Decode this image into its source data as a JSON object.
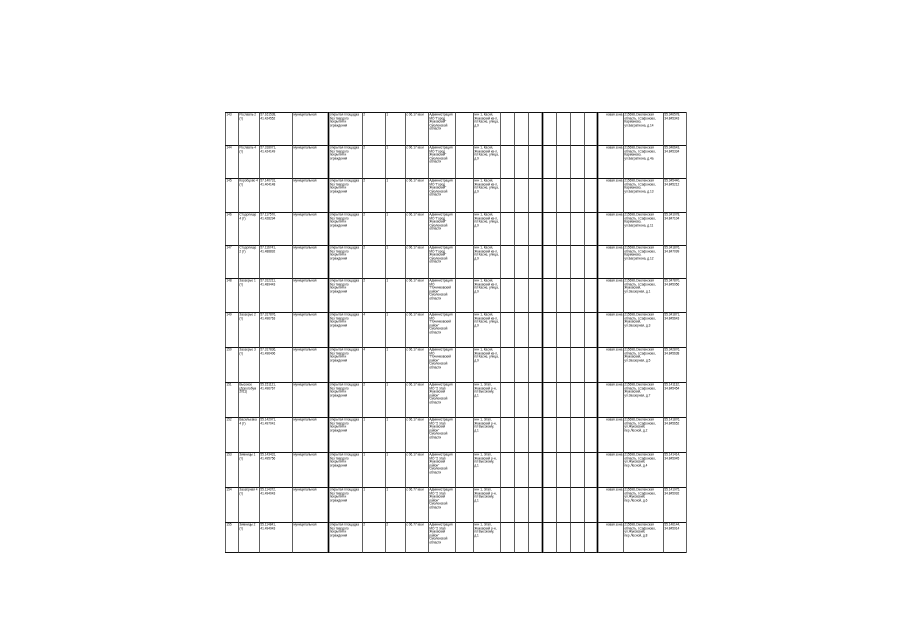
{
  "page": {
    "background_color": "#ffffff",
    "grid_color": "#111111",
    "text_color": "#000000"
  },
  "table": {
    "position": {
      "left": 225,
      "top": 112,
      "width": 461,
      "height": 440
    },
    "columns": [
      {
        "key": "num",
        "width": 13
      },
      {
        "key": "name",
        "width": 21
      },
      {
        "key": "coordinates",
        "width": 33
      },
      {
        "key": "ownership",
        "width": 36
      },
      {
        "key": "description",
        "width": 34
      },
      {
        "key": "count-a",
        "width": 23
      },
      {
        "key": "count-b",
        "width": 20
      },
      {
        "key": "area",
        "width": 23
      },
      {
        "key": "owner",
        "width": 27
      },
      {
        "key": "spacer-1",
        "width": 18
      },
      {
        "key": "location",
        "width": 27
      },
      {
        "key": "spacer-2",
        "width": 14
      },
      {
        "key": "spacer-3",
        "width": 14
      },
      {
        "key": "spacer-4",
        "width": 14
      },
      {
        "key": "spacer-5",
        "width": 14
      },
      {
        "key": "spacer-6",
        "width": 14
      },
      {
        "key": "spacer-7",
        "width": 14
      },
      {
        "key": "spacer-8",
        "width": 13
      },
      {
        "key": "zone-status",
        "width": 26
      },
      {
        "key": "address",
        "width": 40
      },
      {
        "key": "coordinates-2",
        "width": 23
      }
    ],
    "row_heights": [
      33,
      33,
      34,
      33,
      33,
      34,
      35,
      35,
      35,
      35,
      35,
      35,
      30
    ],
    "rows": [
      [
        "143",
        "Рославль 2 (т)",
        "57.161538, 41.424552",
        "муниципальная",
        "открытая площадка без твердого покрытия и ограждения",
        "2",
        "1",
        "с 06.17 кв.м",
        "Администрация МО \"Город Жуковский\" Смоленской области",
        "",
        "м-н 1, Касня, Жуковский кв-л, по Касне, улица, д.9",
        "",
        "",
        "",
        "",
        "",
        "",
        "",
        "новая зона",
        "215698,Смоленская область, г.Сафоново, Карманово, ул.Багратиона, д.14",
        "55.346578, 34.845343"
      ],
      [
        "144",
        "Рославль 4 (т)",
        "57.318071, 41.424149",
        "муниципальная",
        "открытая площадка без твердого покрытия и ограждения",
        "2",
        "1",
        "с 06.17 кв.м",
        "Администрация МО \"Город Жуковский\" Смоленской области",
        "",
        "м-н 1, Касня, Жуковский кв-л, по Касне, улица, д.9",
        "",
        "",
        "",
        "",
        "",
        "",
        "",
        "новая зона",
        "215698,Смоленская область, г.Сафоново, Карманово, ул.Багратиона, д.4а",
        "55.346643, 34.845334"
      ],
      [
        "145",
        "Коробцово 4 (т)",
        "57.140731, 41.404148",
        "муниципальная",
        "открытая площадка без твердого покрытия и ограждения",
        "2",
        "1",
        "с 06.17 кв.м",
        "Администрация МО \"Город Жуковский\" Смоленской области",
        "",
        "м-н 1, Касня, Жуковский кв-л, по Касне, улица, д.9",
        "",
        "",
        "",
        "",
        "",
        "",
        "",
        "новая зона",
        "215698,Смоленская область, г.Сафоново, Карманово, ул.Багратиона, д.13",
        "55.345440, 34.845212"
      ],
      [
        "146",
        "Стодолище 4 (т)",
        "57.117570, 41.428294",
        "муниципальная",
        "открытая площадка без твердого покрытия и ограждения",
        "2",
        "1",
        "с 06.17 кв.м",
        "Администрация МО \"Город Жуковский\" Смоленской области",
        "",
        "м-н 1, Касня, Жуковский кв-л, по Касне, улица, д.9",
        "",
        "",
        "",
        "",
        "",
        "",
        "",
        "новая зона",
        "215698,Смоленская область, г.Сафоново, Карманово, ул.Багратиона, д.11",
        "55.341078, 34.847104"
      ],
      [
        "147",
        "Стодолище 2 (т)",
        "57.116741, 41.488892",
        "муниципальная",
        "открытая площадка без твердого покрытия и ограждения",
        "2",
        "1",
        "с 06.17 кв.м",
        "Администрация МО \"Город Жуковский\" Смоленской области",
        "",
        "м-н 1, Касня, Жуковский кв-л, по Касне, улица, д.9",
        "",
        "",
        "",
        "",
        "",
        "",
        "",
        "новая зона",
        "215698,Смоленская область, г.Сафоново, Карманово, ул.Багратиона, д.12",
        "55.341876, 34.847099"
      ],
      [
        "148",
        "Заозерье 1 (т)",
        "57.312211, 41.489443",
        "муниципальная",
        "открытая площадка без твердого покрытия и ограждения",
        "2",
        "1",
        "с 06.17 кв.м",
        "Администрация МО \"Починковский район\" Смоленской области",
        "",
        "м-н 1, Касня, Жуковский кв-л, по Касне, улица, д.9",
        "",
        "",
        "",
        "",
        "",
        "",
        "",
        "новая зона",
        "215698,Смоленская область, г.Сафоново, Жуковский, ул.Заозерная, д.1",
        "55.347870, 34.845956"
      ],
      [
        "149",
        "Заозерье 2 (т)",
        "57.317876, 41.496763",
        "муниципальная",
        "открытая площадка без твердого покрытия и ограждения",
        "4",
        "1",
        "с 06.17 кв.м",
        "Администрация МО \"Починковский район\" Смоленской области",
        "",
        "м-н 1, Касня, Жуковский кв-л, по Касне, улица, д.9",
        "",
        "",
        "",
        "",
        "",
        "",
        "",
        "новая зона",
        "215698,Смоленская область, г.Сафоново, Жуковский, ул.Заозерная, д.3",
        "55.341871, 34.845643"
      ],
      [
        "150",
        "Заозерье 3 (т)",
        "57.317836, 41.496406",
        "муниципальная",
        "открытая площадка без твердого покрытия и ограждения",
        "4",
        "1",
        "с 06.17 кв.м",
        "Администрация МО \"Починковский район\" Смоленской области",
        "",
        "м-н 1, Касня, Жуковский кв-л, по Касне, улица, д.9",
        "",
        "",
        "",
        "",
        "",
        "",
        "",
        "новая зона",
        "215698,Смоленская область, г.Сафоново, Жуковский, ул.Заозерная, д.5",
        "55.342876, 34.845638"
      ],
      [
        "151",
        "Высокое (Дорогобуж 2011)",
        "55.151121, 41.496767",
        "муниципальная",
        "открытая площадка без твердого покрытия и ограждения",
        "2",
        "1",
        "с 06.17 кв.м",
        "Администрация МО \"2 этап Жуковский район\" Смоленской области",
        "",
        "м-н 1, Этап, Жуковский р-н, по Высокому, д.1",
        "",
        "",
        "",
        "",
        "",
        "",
        "",
        "новая зона",
        "215698,Смоленская область, г.Сафоново, Жуковский, ул.Заозерная, д.7",
        "55.141132, 34.845454"
      ],
      [
        "152",
        "Васильевка 4 (т)",
        "55.142971, 41.497041",
        "муниципальная",
        "открытая площадка без твердого покрытия и ограждения",
        "1",
        "1",
        "с 06.17 кв.м",
        "Администрация МО \"2 этап Жуковский район\" Смоленской области",
        "",
        "м-н 1, Этап, Жуковский р-н, по Высокому, д.1",
        "",
        "",
        "",
        "",
        "",
        "",
        "",
        "новая зона",
        "215698,Смоленская область, г.Сафоново, ул.Жуковский, пер.Лесной, д.2",
        "55.141876, 34.845652"
      ],
      [
        "153",
        "Зимницы 1 (т)",
        "55.143431, 41.495756",
        "муниципальная",
        "открытая площадка без твердого покрытия и ограждения",
        "1",
        "1",
        "с 06.17 кв.м",
        "Администрация МО \"2 этап Жуковский район\" Смоленской области",
        "",
        "м-н 1, Этап, Жуковский р-н, по Высокому, д.1",
        "",
        "",
        "",
        "",
        "",
        "",
        "",
        "новая зона",
        "215698,Смоленская область, г.Сафоново, ул.Жуковский, пер.Лесной, д.4",
        "55.141414, 34.845945"
      ],
      [
        "154",
        "Заозёрная 4 (т)",
        "55.114372, 41.494043",
        "муниципальная",
        "открытая площадка без твердого покрытия и ограждения",
        "1",
        "1",
        "с 06.77 кв.м",
        "Администрация МО \"2 этап Жуковский район\" Смоленской области",
        "",
        "м-н 1, Этап, Жуковский р-н, по Высокому, д.1",
        "",
        "",
        "",
        "",
        "",
        "",
        "",
        "новая зона",
        "215698,Смоленская область, г.Сафоново, ул.Жуковский, пер.Лесной, д.6",
        "55.141975, 34.845992"
      ],
      [
        "155",
        "Зимницы 2 (т)",
        "55.114841, 41.494943",
        "муниципальная",
        "открытая площадка без твердого покрытия и ограждения",
        "2",
        "2",
        "с 06.77 кв.м",
        "Администрация МО \"2 этап Жуковский район\" Смоленской области",
        "",
        "м-н 1, Этап, Жуковский р-н, по Высокому, д.1",
        "",
        "",
        "",
        "",
        "",
        "",
        "",
        "новая зона",
        "215698,Смоленская область, г.Сафоново, ул.Жуковский, пер.Лесной, д.8",
        "55.146144, 34.845914"
      ]
    ]
  }
}
